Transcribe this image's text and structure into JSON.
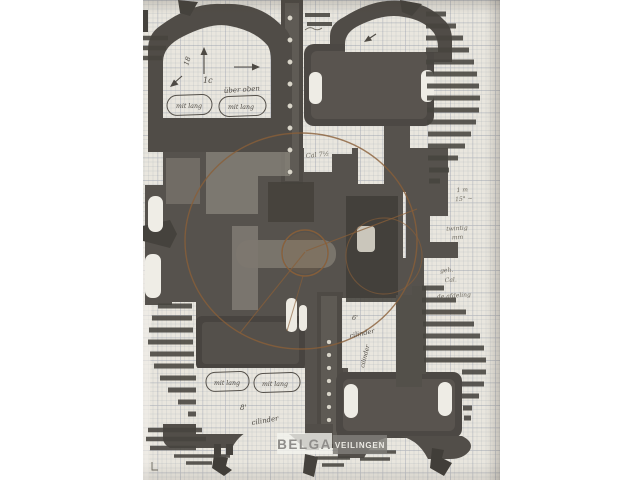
{
  "colors": {
    "page_bg": "#ffffff",
    "paper": "#e9e6de",
    "grid_line": "#9ba2ac",
    "ink_dark": "#524e49",
    "ink_mid": "#6b6660",
    "sepia_accent": "#8a5f38",
    "pencil": "#6e6a60",
    "watermark_text": "#8f8d8a",
    "watermark_box": "#7f7c78"
  },
  "watermark": {
    "primary": "BELGA",
    "secondary": "VEILINGEN"
  },
  "annotations": {
    "top_panel": {
      "angle_mark": "18",
      "scale_mark": "1c",
      "note": "über oben",
      "stamp_left": "mit lang",
      "stamp_right": "mit lang"
    },
    "center_note": "Cal 7½",
    "right_margin": {
      "line1": "1 m",
      "line2": "15° ~",
      "line3": "twintig",
      "line4": "mm",
      "line5": "geh.",
      "line6": "Cal.",
      "line7": "de afdeling"
    },
    "bottom_left_panel": {
      "size_mark": "8'",
      "note": "cilinder",
      "stamp_left": "mit lang",
      "stamp_right": "mit lang"
    },
    "bottom_right_panel": {
      "size_mark": "6'",
      "note": "cilinder",
      "vertical_note": "cilinder"
    }
  }
}
